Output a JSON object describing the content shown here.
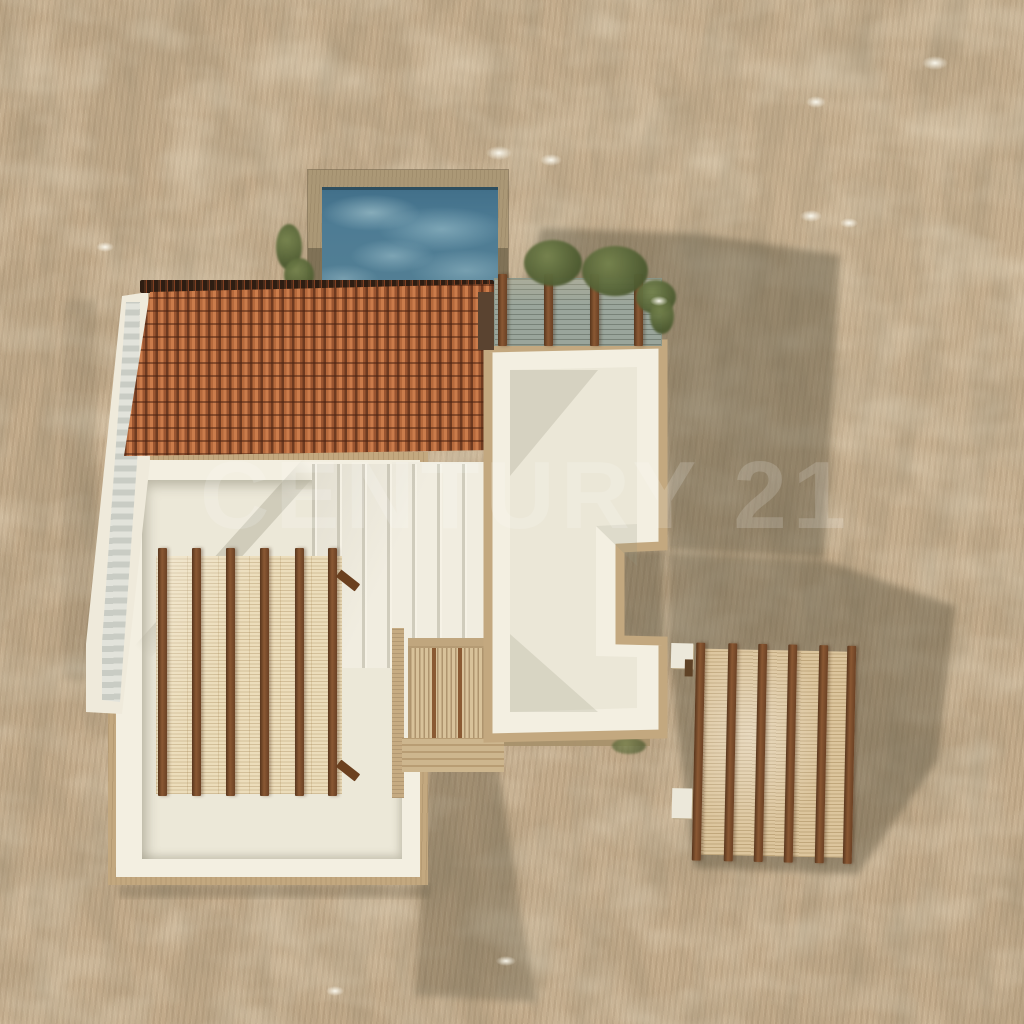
{
  "watermark": {
    "text": "CENTURY 21"
  },
  "scene": {
    "type": "3d-architectural-aerial-render",
    "description": "Top-down aerial 3D rendering of a Mediterranean-style villa with flat white roof terraces, a terracotta tiled roof section, a swimming pool, wooden pergolas with bamboo shading, an exterior staircase and surrounding dry grass terrain",
    "objects": [
      "swimming-pool",
      "terracotta-tiled-roof",
      "white-roof-terrace-left-wing",
      "white-roof-terrace-right-wing",
      "exterior-staircase",
      "pool-side-pergola-with-shrubs",
      "left-wing-wood-beam-pergola",
      "detached-wood-beam-pergola",
      "bamboo-canopy-walkway",
      "cast-shadows",
      "dry-grass-terrain",
      "shrubs-and-flower-tufts"
    ]
  },
  "colors": {
    "terrain": "#c2aa8a",
    "terrain_shadow": "#564f3a",
    "pool_water": "#4e7c94",
    "pool_coping": "#ab9876",
    "roof_tile": "#b5693c",
    "roof_rib": "#6e3a20",
    "wall_cream": "#f3efe1",
    "floor_cream": "#ece8d8",
    "coping_tan": "#c3a87f",
    "beam_brown": "#7b4e2b",
    "bamboo_light": "#ecddbb",
    "bamboo_dark": "#dcc59d",
    "deck_grey": "#9aa59b",
    "bush_green": "#5d6a3c",
    "watermark_white": "rgba(255,255,255,0.16)"
  }
}
